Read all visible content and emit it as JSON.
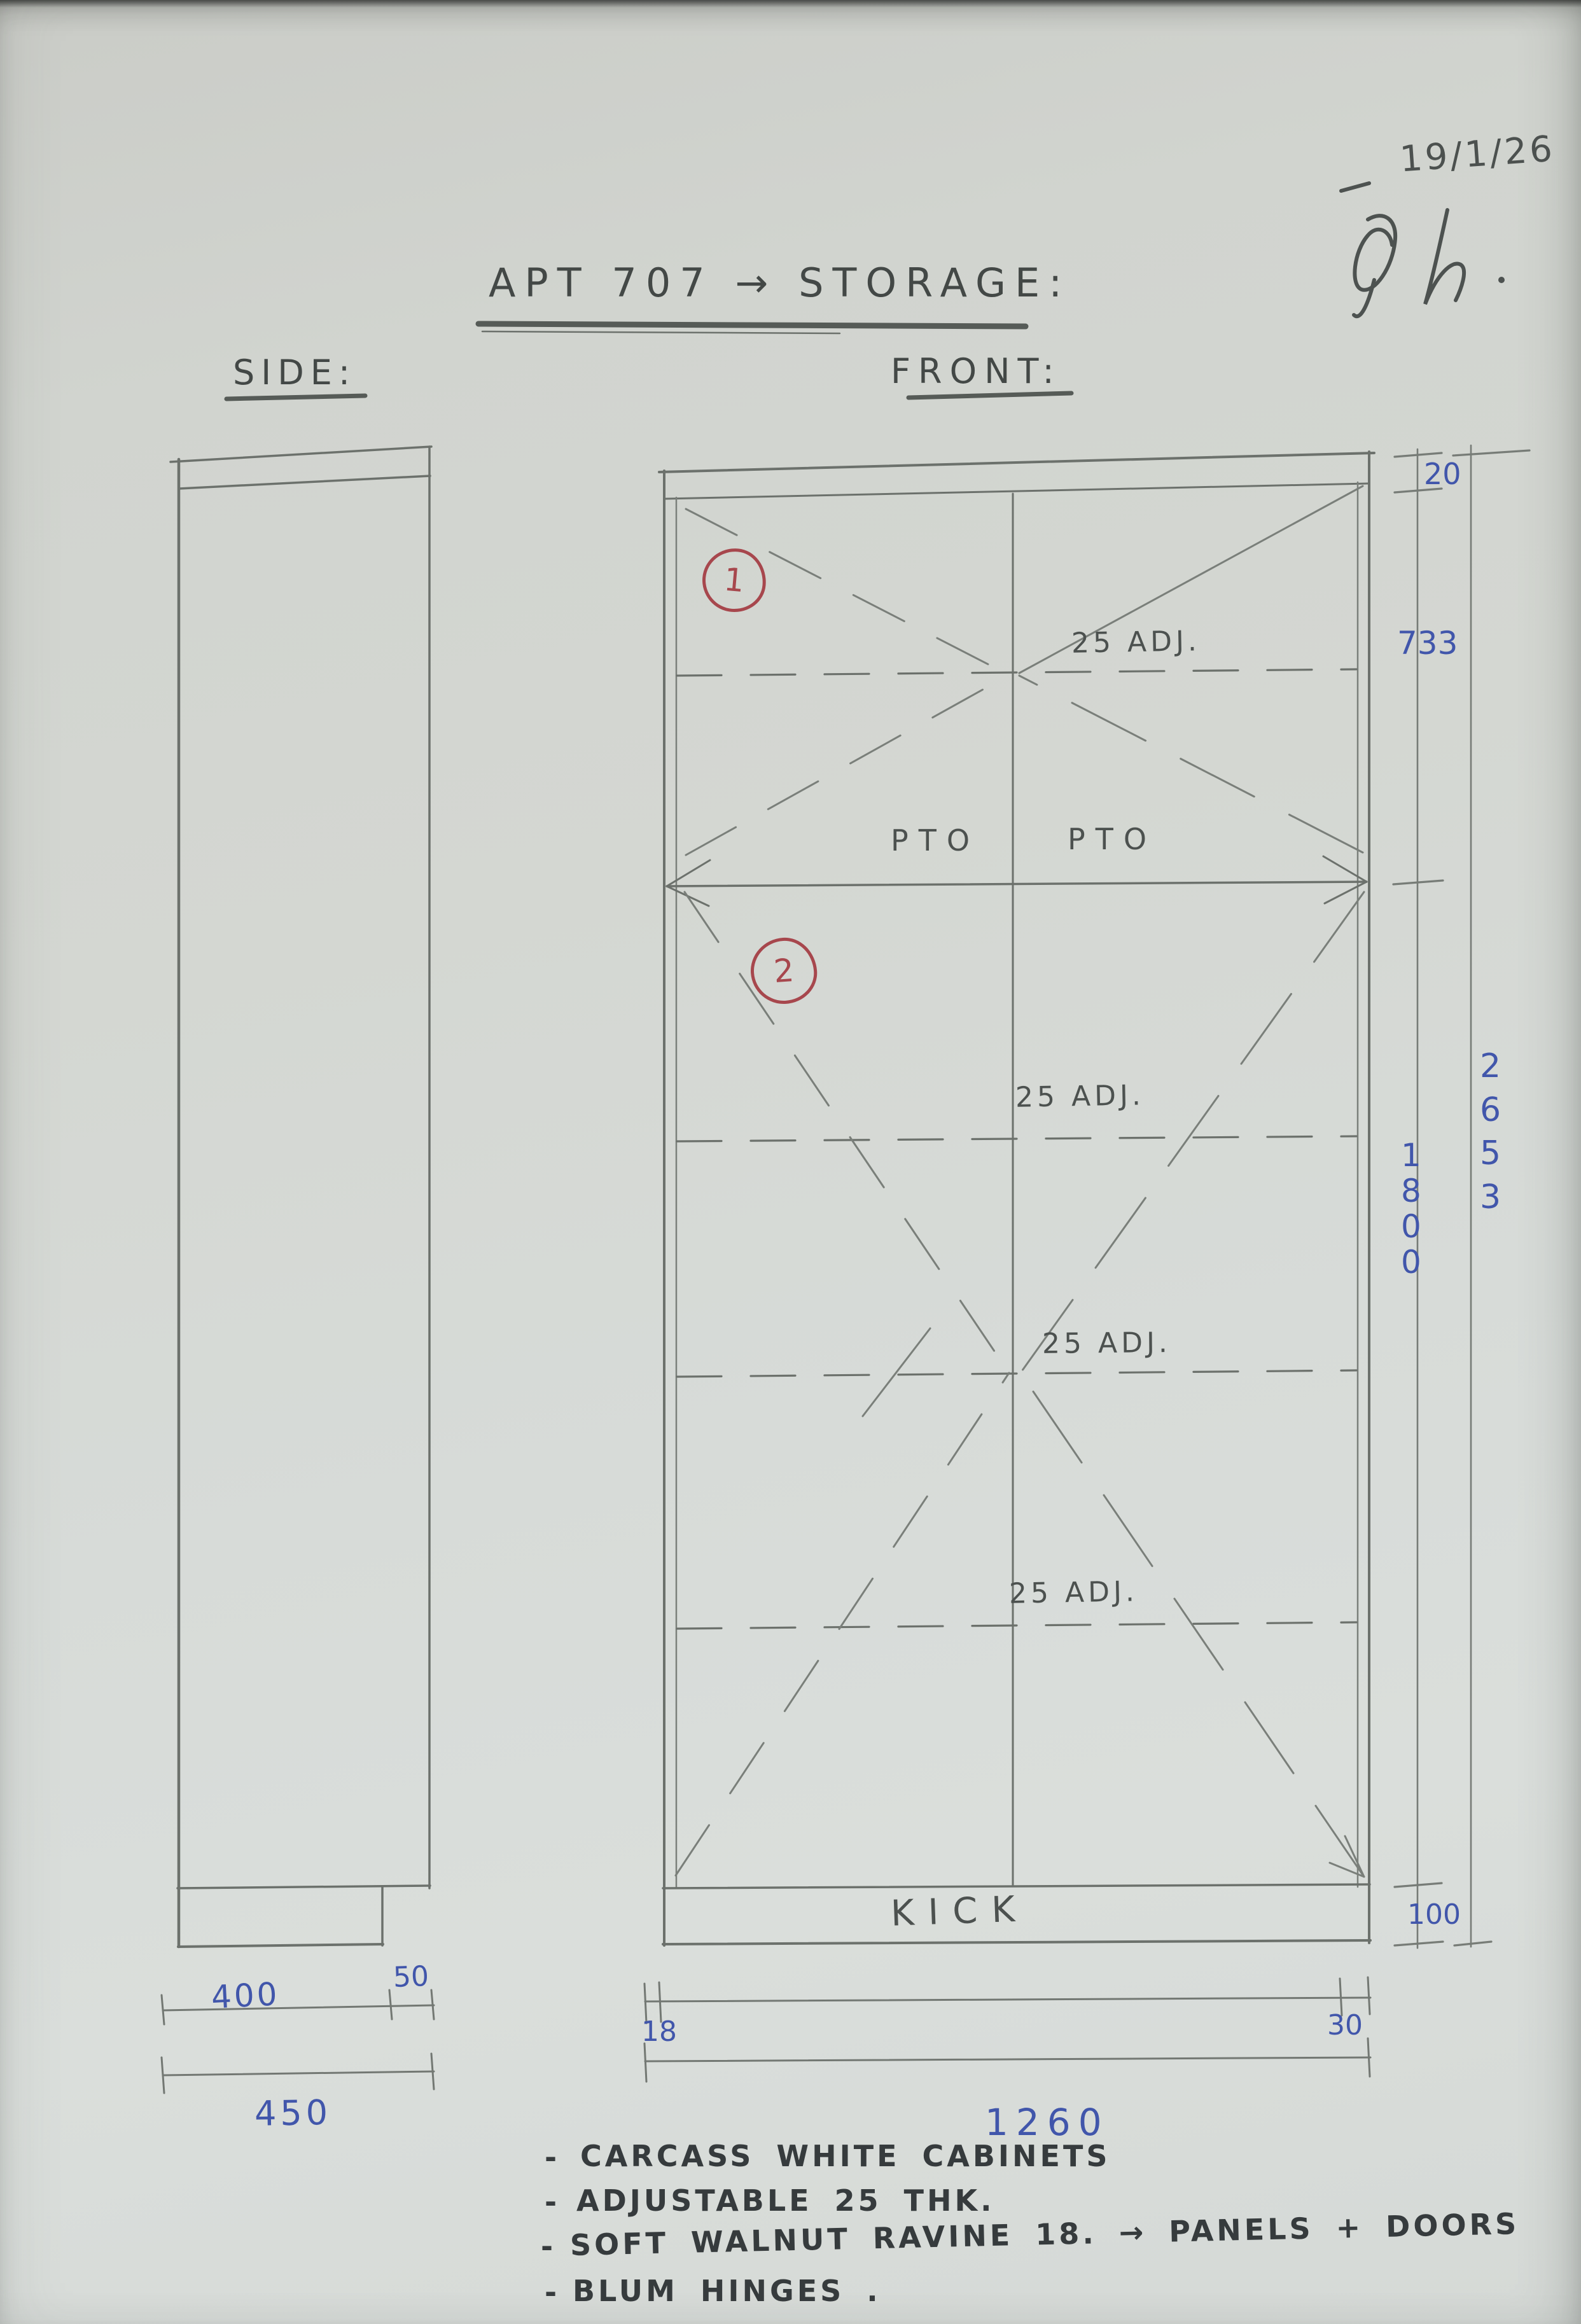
{
  "page": {
    "title": "APT 707 → STORAGE:",
    "date": "19/1/26",
    "signature_reading": "TyL"
  },
  "views": {
    "side_label": "SIDE:",
    "front_label": "FRONT:"
  },
  "front": {
    "badge_1": "1",
    "badge_2": "2",
    "pto_left": "PTO",
    "pto_right": "PTO",
    "kick_label": "KICK",
    "shelf_labels": [
      "25 ADJ.",
      "25 ADJ.",
      "25 ADJ.",
      "25 ADJ."
    ]
  },
  "dimensions": {
    "top_panel_thk": "20",
    "unit1_height": "733",
    "unit2_height": "1800",
    "total_height": "2653",
    "kick_height": "100",
    "panel_left_thk": "18",
    "panel_right_thk": "30",
    "total_width": "1260",
    "carcass_depth": "400",
    "door_zone_depth": "50",
    "total_depth": "450"
  },
  "notes": {
    "bullet": "-",
    "items": [
      "CARCASS WHITE CABINETS",
      "ADJUSTABLE 25 THK.",
      "SOFT WALNUT RAVINE 18. → PANELS + DOORS",
      "BLUM HINGES ."
    ]
  },
  "colors": {
    "paper": "#d4d7d2",
    "pencil": "#6c716c",
    "pencil_text": "#4c514f",
    "notes_text": "#363b3d",
    "ink_blue": "#4156ab",
    "red": "#a7474d"
  }
}
